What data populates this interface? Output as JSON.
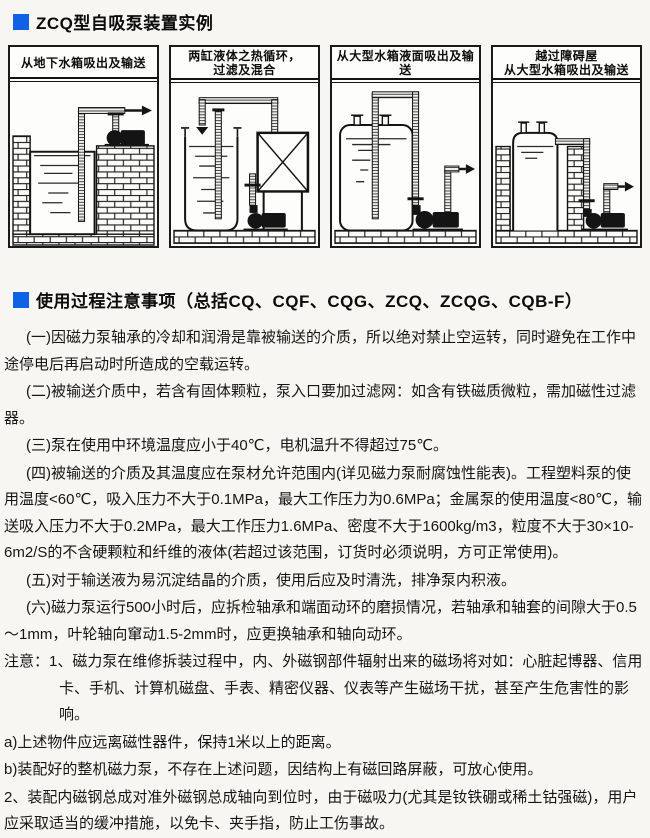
{
  "page": {
    "section1": {
      "title": "ZCQ型自吸泵装置实例"
    },
    "section2": {
      "title": "使用过程注意事项（总括CQ、CQF、CQG、ZCQ、ZCQG、CQB-F）"
    }
  },
  "colors": {
    "accent_blue": "#1161e6",
    "ink": "#141414"
  },
  "diagrams": [
    {
      "title": "从地下水箱吸出及输送"
    },
    {
      "title": "两缸液体之热循环，\n过滤及混合"
    },
    {
      "title": "从大型水箱液面吸出及输送"
    },
    {
      "title": "越过障碍屋\n从大型水箱吸出及输送"
    }
  ],
  "notes": {
    "paragraphs": [
      "(一)因磁力泵轴承的冷却和润滑是靠被输送的介质，所以绝对禁止空运转，同时避免在工作中途停电后再启动时所造成的空载运转。",
      "(二)被输送介质中，若含有固体颗粒，泵入口要加过滤网：如含有铁磁质微粒，需加磁性过滤器。",
      "(三)泵在使用中环境温度应小于40℃，电机温升不得超过75℃。",
      "(四)被输送的介质及其温度应在泵材允许范围内(详见磁力泵耐腐蚀性能表)。工程塑料泵的使用温度<60℃，吸入压力不大于0.1MPa，最大工作压力为0.6MPa；金属泵的使用温度<80℃，输送吸入压力不大于0.2MPa，最大工作压力1.6MPa、密度不大于1600kg/m3，粒度不大于30×10-6m2/S的不含硬颗粒和纤维的液体(若超过该范围，订货时必须说明，方可正常使用)。",
      "(五)对于输送液为易沉淀结晶的介质，使用后应及时清洗，排净泵内积液。",
      "(六)磁力泵运行500小时后，应拆检轴承和端面动环的磨损情况，若轴承和轴套的间隙大于0.5～1mm，叶轮轴向窜动1.5-2mm时，应更换轴承和轴向动环。"
    ],
    "caution_label": "注意：",
    "caution_items": [
      "1、磁力泵在维修拆装过程中，内、外磁钢部件辐射出来的磁场将对如：心脏起博器、信用卡、手机、计算机磁盘、手表、精密仪器、仪表等产生磁场干扰，甚至产生危害性的影响。",
      "a)上述物件应远离磁性器件，保持1米以上的距离。",
      "b)装配好的整机磁力泵，不存在上述问题，因结构上有磁回路屏蔽，可放心使用。",
      "2、装配内磁钢总成对准外磁钢总成轴向到位时，由于磁吸力(尤其是钕铁硼或稀土钴强磁)，用户应采取适当的缓冲措施，以免卡、夹手指，防止工伤事故。"
    ]
  }
}
